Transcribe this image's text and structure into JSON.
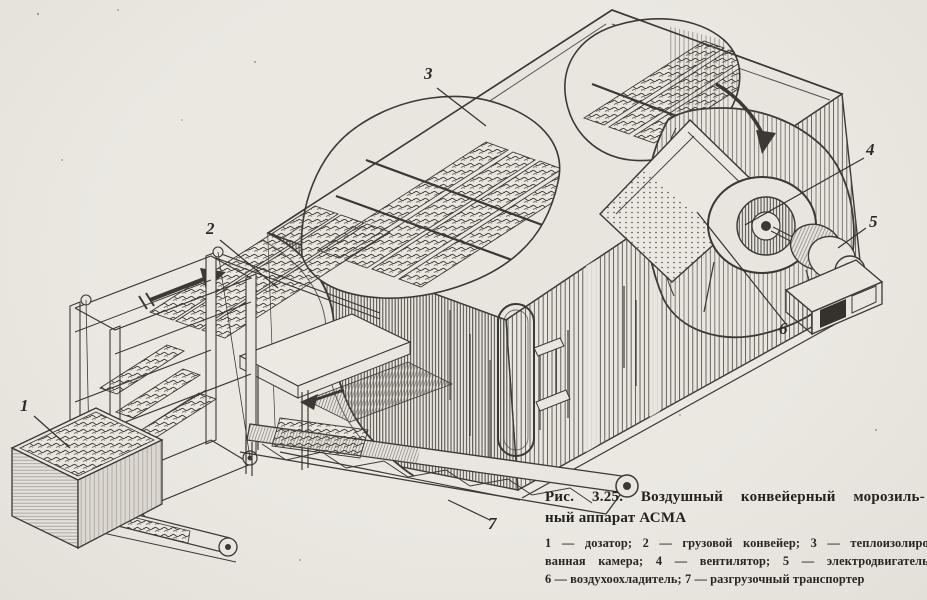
{
  "figure": {
    "caption": {
      "line1": "Рис. 3.25. Воздушный конвейерный морозиль-",
      "line2": "ный аппарат АСМА"
    },
    "legend_lines": [
      "1 — дозатор; 2 — грузовой конвейер; 3 — теплоизолиро-",
      "ванная камера; 4 — вентилятор; 5 — электродвигатель;",
      "6 — воздухоохладитель; 7 — разгрузочный транспортер"
    ]
  },
  "callouts": [
    {
      "num": "1",
      "part": "дозатор"
    },
    {
      "num": "2",
      "part": "грузовой конвейер"
    },
    {
      "num": "3",
      "part": "теплоизолированная камера"
    },
    {
      "num": "4",
      "part": "вентилятор"
    },
    {
      "num": "5",
      "part": "электродвигатель"
    },
    {
      "num": "6",
      "part": "воздухоохладитель"
    },
    {
      "num": "7",
      "part": "разгрузочный транспортер"
    }
  ],
  "colors": {
    "paper": "#e9e6e0",
    "ink": "#3b3835"
  }
}
